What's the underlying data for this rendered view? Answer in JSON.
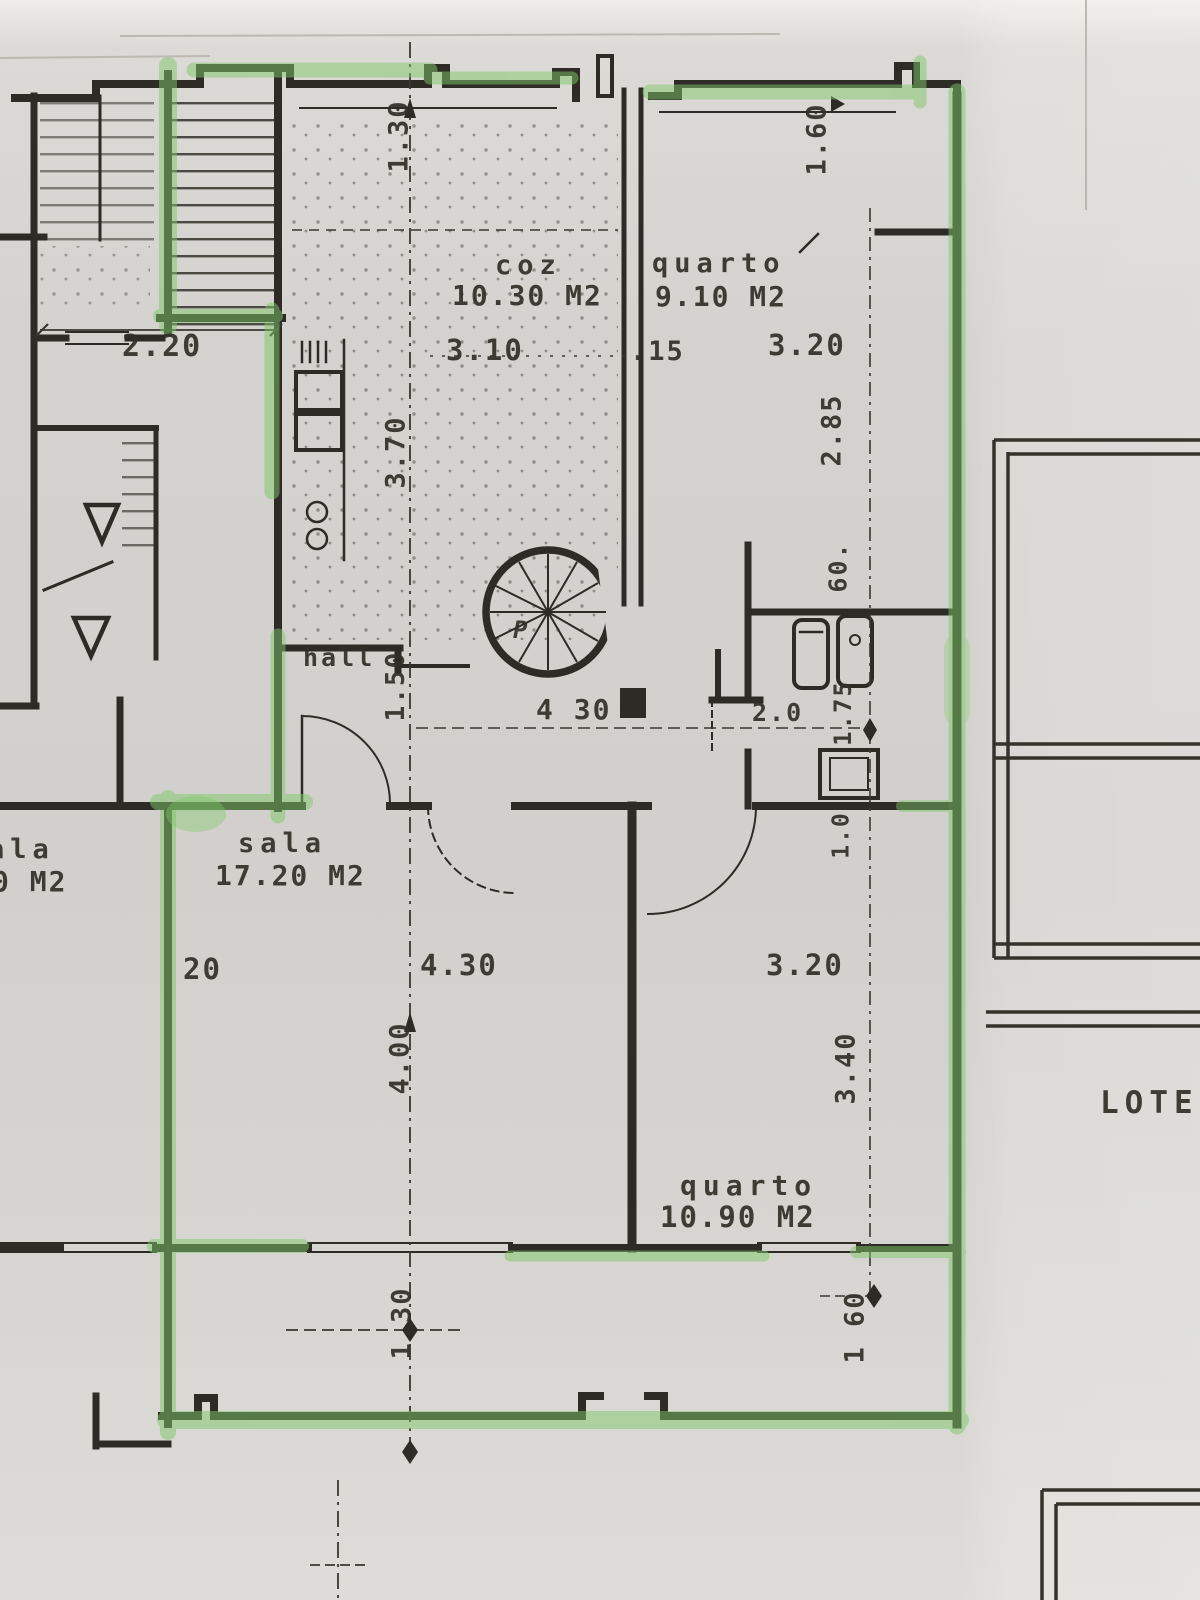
{
  "rooms": {
    "kitchen": {
      "name": "coz",
      "area": "10.30 M2"
    },
    "bedroom_top": {
      "name": "quarto",
      "area": "9.10 M2"
    },
    "hall": {
      "name": "hall"
    },
    "living": {
      "name": "sala",
      "area": "17.20 M2"
    },
    "living_left_clipped": {
      "name": "ala",
      "area": "0 M2"
    },
    "bedroom_bottom": {
      "name": "quarto",
      "area": "10.90 M2"
    }
  },
  "stairs": {
    "spiral_label": "P"
  },
  "site": {
    "lote": "LOTE"
  },
  "dims": {
    "v130_top": "1.30",
    "v160_top": "1.60",
    "h220": "2.20",
    "h310": "3.10",
    "h15": ".15",
    "h320_top": "3.20",
    "v370": "3.70",
    "v285": "2.85",
    "v60": "60.",
    "v150": "1.50",
    "h430_mid": "4 30",
    "h20_mid": "2.0",
    "v175": "1.75",
    "v10": "1.0",
    "h20_sala": "20",
    "h430_sala": "4.30",
    "h320_sala": "3.20",
    "v400": "4.00",
    "v340": "3.40",
    "v130_bot": "1.30",
    "v160_bot": "1 60"
  },
  "colors": {
    "highlighter": "#7dc868",
    "ink": "#2e2b26",
    "paper": "#d6d4d0"
  }
}
